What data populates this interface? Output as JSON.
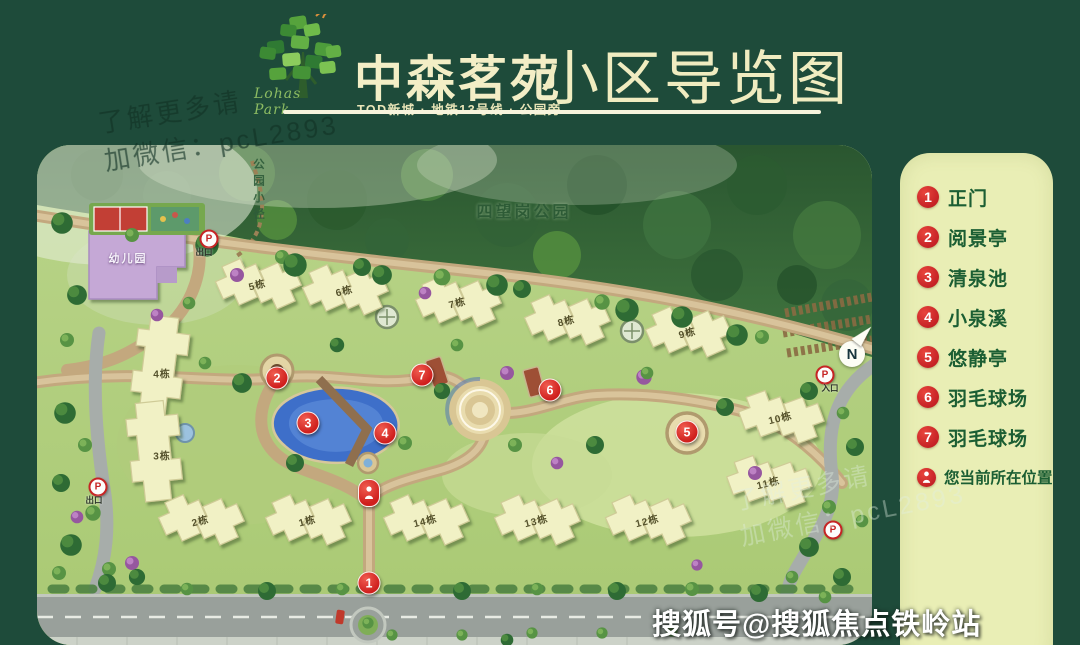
{
  "header": {
    "brand_script": "Lohas Park",
    "title": "中森茗苑",
    "subtitle": "TOD新城 · 地铁13号线 · 公园旁",
    "map_title": "小区导览图"
  },
  "watermarks": {
    "wechat_line1": "了解更多请",
    "wechat_line2": "加微信：pcL2893",
    "sohu": "搜狐号@搜狐焦点铁岭站"
  },
  "legend": {
    "items": [
      {
        "badge": "1",
        "label": "正门"
      },
      {
        "badge": "2",
        "label": "阅景亭"
      },
      {
        "badge": "3",
        "label": "清泉池"
      },
      {
        "badge": "4",
        "label": "小泉溪"
      },
      {
        "badge": "5",
        "label": "悠静亭"
      },
      {
        "badge": "6",
        "label": "羽毛球场"
      },
      {
        "badge": "7",
        "label": "羽毛球场"
      },
      {
        "badge": "person-icon",
        "label": "您当前所在位置"
      }
    ]
  },
  "map": {
    "park_name": "四望岗公园",
    "trail_name": "公园小径",
    "kindergarten": "幼儿园",
    "compass": "N",
    "exit_label": "出口",
    "entry_label": "入口",
    "parking_letter": "P",
    "buildings": [
      "1栋",
      "2栋",
      "3栋",
      "4栋",
      "5栋",
      "6栋",
      "7栋",
      "8栋",
      "9栋",
      "10栋",
      "11栋",
      "12栋",
      "13栋",
      "14栋"
    ],
    "markers": [
      "1",
      "2",
      "3",
      "4",
      "5",
      "6",
      "7"
    ]
  },
  "colors": {
    "background_green": "#1e4b3a",
    "legend_cream": "#e9eeb5",
    "title_cream": "#f3eec6",
    "marker_red": "#cf1f1d",
    "legend_text_green": "#1b5e33",
    "pond_blue": "#3e6fc9"
  }
}
